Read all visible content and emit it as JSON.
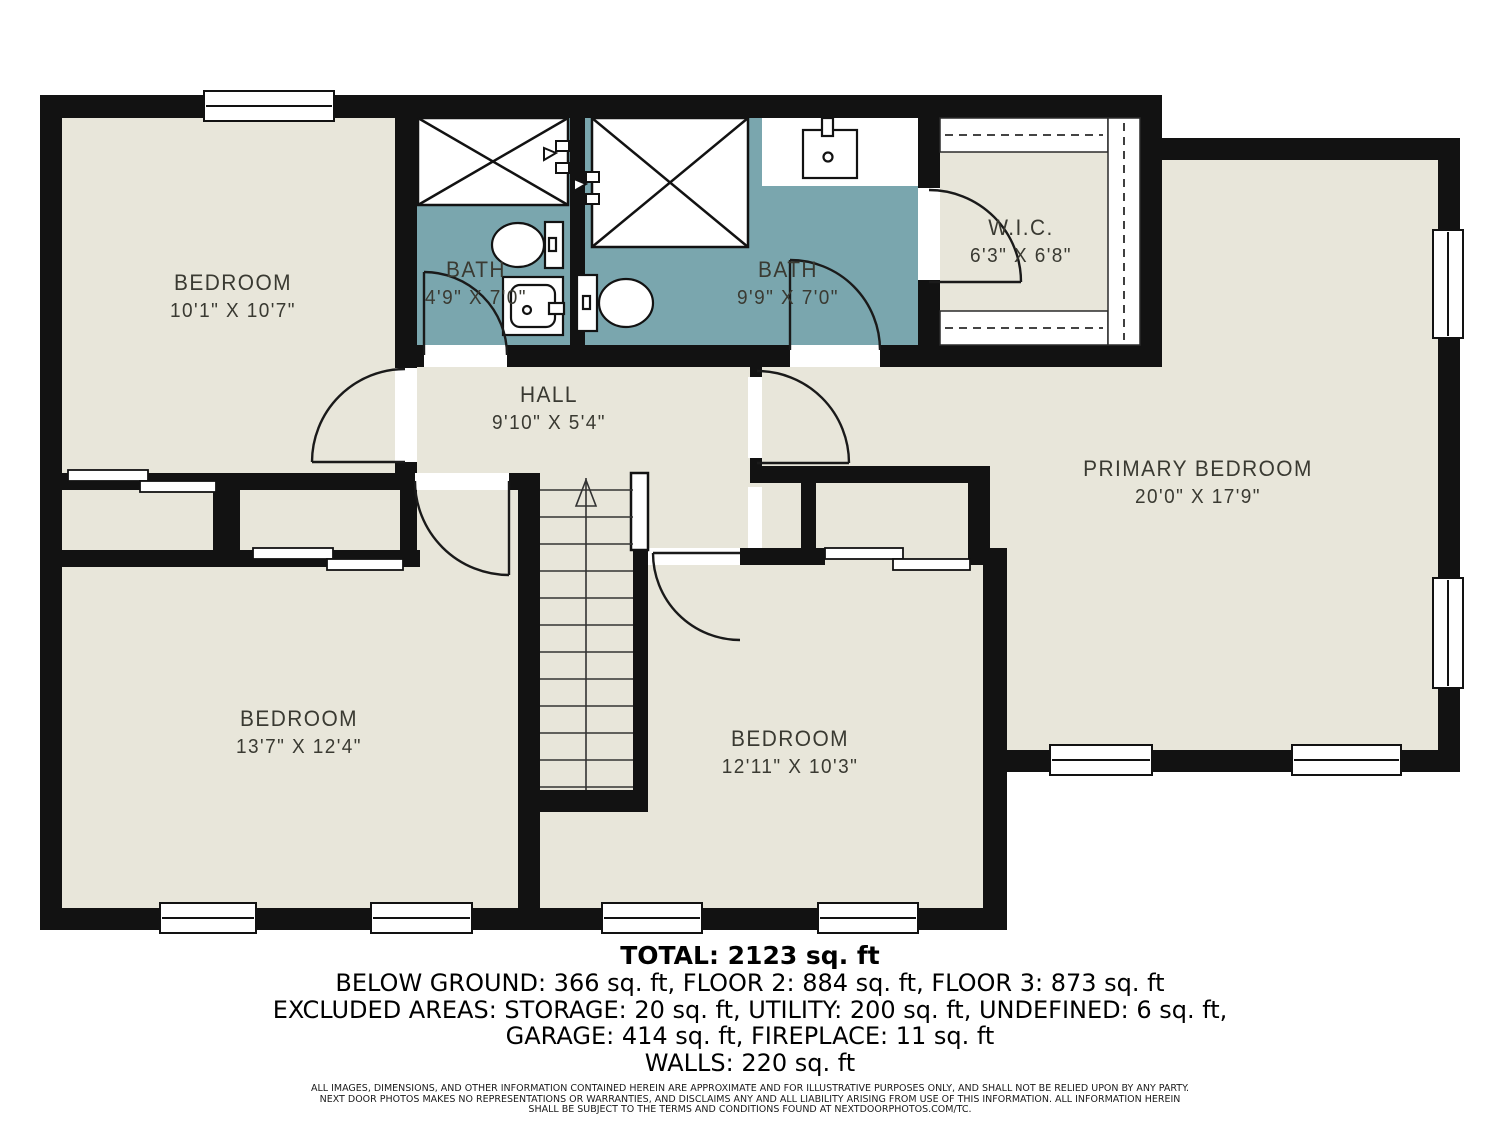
{
  "colors": {
    "floor": "#E8E6DA",
    "bath_floor": "#7AA6AE",
    "wall": "#121212",
    "label_text": "#3A3A32",
    "page_background": "#FFFFFF"
  },
  "rooms": {
    "bedroom_tl": {
      "name": "BEDROOM",
      "dims": "10'1\" X 10'7\""
    },
    "bath_small": {
      "name": "BATH",
      "dims": "4'9\" X 7'0\""
    },
    "bath_large": {
      "name": "BATH",
      "dims": "9'9\" X 7'0\""
    },
    "wic": {
      "name": "W.I.C.",
      "dims": "6'3\" X 6'8\""
    },
    "hall": {
      "name": "HALL",
      "dims": "9'10\" X 5'4\""
    },
    "primary": {
      "name": "PRIMARY BEDROOM",
      "dims": "20'0\" X 17'9\""
    },
    "bedroom_bl": {
      "name": "BEDROOM",
      "dims": "13'7\" X 12'4\""
    },
    "bedroom_bm": {
      "name": "BEDROOM",
      "dims": "12'11\" X 10'3\""
    }
  },
  "summary": {
    "total": "TOTAL: 2123 sq. ft",
    "line1": "BELOW GROUND: 366 sq. ft, FLOOR 2: 884 sq. ft, FLOOR 3: 873 sq. ft",
    "line2": "EXCLUDED AREAS: STORAGE: 20 sq. ft, UTILITY: 200 sq. ft, UNDEFINED: 6 sq. ft,",
    "line3": "GARAGE: 414 sq. ft, FIREPLACE: 11 sq. ft",
    "line4": "WALLS: 220 sq. ft"
  },
  "disclaimer": {
    "line1": "ALL IMAGES, DIMENSIONS, AND OTHER INFORMATION CONTAINED HEREIN ARE APPROXIMATE AND FOR ILLUSTRATIVE PURPOSES ONLY, AND SHALL NOT BE RELIED UPON BY ANY PARTY.",
    "line2": "NEXT DOOR PHOTOS MAKES NO REPRESENTATIONS OR WARRANTIES, AND DISCLAIMS ANY AND ALL LIABILITY ARISING FROM USE OF THIS INFORMATION. ALL INFORMATION HEREIN",
    "line3": "SHALL BE SUBJECT TO THE TERMS AND CONDITIONS FOUND AT NEXTDOORPHOTOS.COM/TC."
  }
}
